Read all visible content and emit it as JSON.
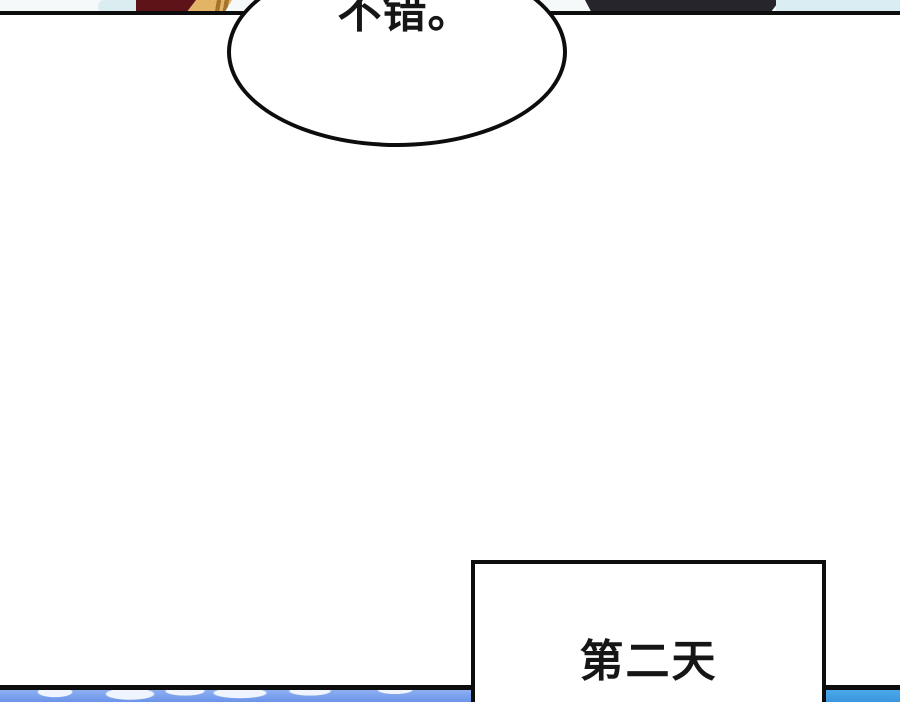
{
  "speech_bubble": {
    "text": "不错。"
  },
  "caption_box": {
    "text": "第二天"
  },
  "colors": {
    "page-bg": "#ffffff",
    "top-sky-white": "#f6f9f9",
    "top-sky-blue-left": "#dcedf2",
    "maroon": "#5e1318",
    "gold": "#e3b366",
    "gold-stripe": "#a4742f",
    "dark-figure": "#27252c",
    "top-sky-blue-right": "#d9edf2",
    "line": "#0d0d0d",
    "ink": "#161616",
    "bubble-fill": "#ffffff",
    "sky-left": "#8db0f2",
    "sky-left-deep": "#6b93e9",
    "cloud": "#eff4fe",
    "sky-right": "#4aa9ea",
    "sky-right-deep": "#3b96dd"
  }
}
